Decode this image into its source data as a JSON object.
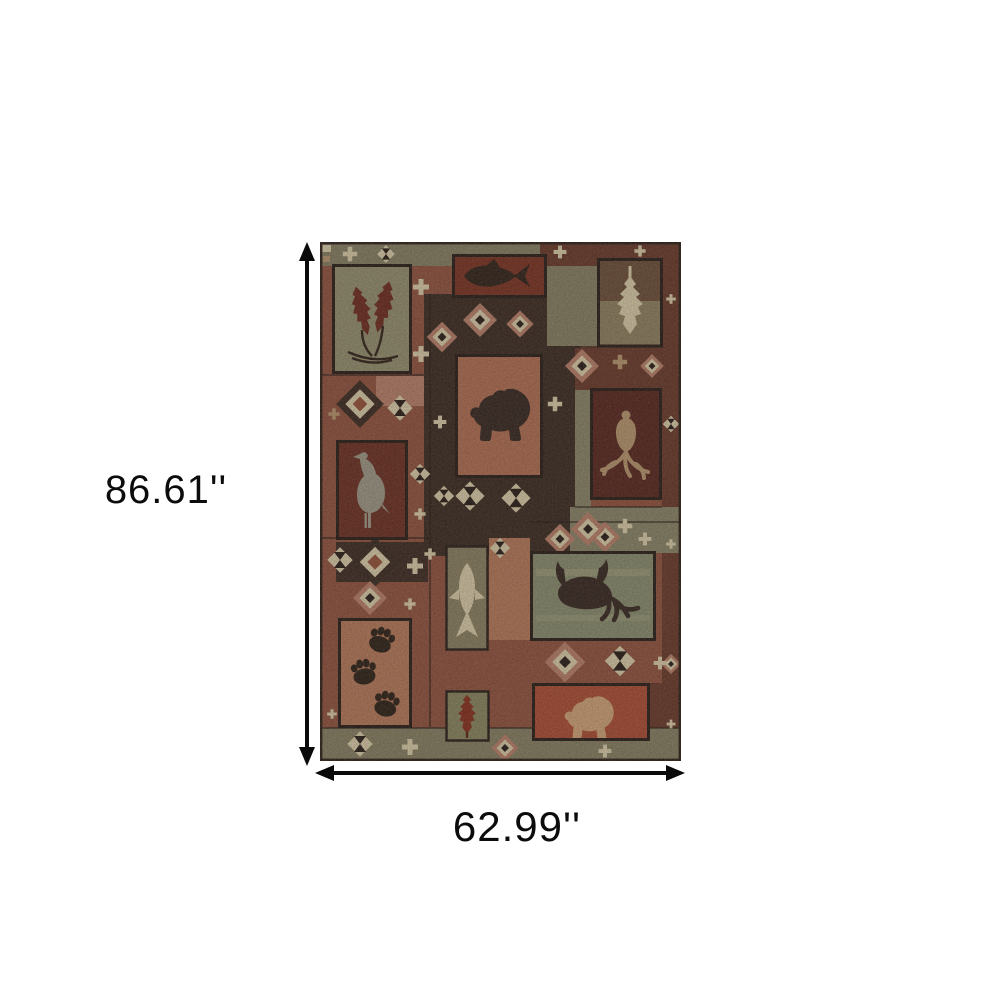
{
  "diagram": {
    "height_label": "86.61''",
    "width_label": "62.99''"
  },
  "rug": {
    "description": "Lodge patchwork area rug with wildlife and southwestern motifs",
    "motifs": [
      "maple leaves",
      "fish",
      "pinecone",
      "bear",
      "deer antlers",
      "bird",
      "vertical fish",
      "moose",
      "bear paw prints",
      "oak leaf",
      "cream bear",
      "stepped diamonds",
      "hourglass diamonds",
      "cross medallions"
    ],
    "palette": {
      "base_rust": "#96503a",
      "rust": "#9a4e34",
      "salmon": "#c28168",
      "clay": "#bf7a58",
      "terracotta": "#b96e50",
      "red": "#b34a2f",
      "brick": "#7e2d1c",
      "dark_red": "#6e2a1c",
      "maroon": "#6b3524",
      "dark_maroon": "#582018",
      "brown": "#6d4c34",
      "dark_brown": "#38251b",
      "ink": "#241610",
      "silhouette": "#2c1b12",
      "bear_dark": "#33211a",
      "olive": "#8f8261",
      "olive_strip": "#8a8162",
      "olive_panel": "#8d885f",
      "olive_light": "#93835f",
      "sage": "#8e9070",
      "sage_strip": "#8e8768",
      "green_gray": "#99926f",
      "tan": "#c09a6e",
      "cream": "#e7d7b0",
      "cream_bear": "#dba878",
      "feather_gray": "#a39c88",
      "leaf_maroon": "#702518",
      "oak_red": "#8c2a16"
    }
  }
}
